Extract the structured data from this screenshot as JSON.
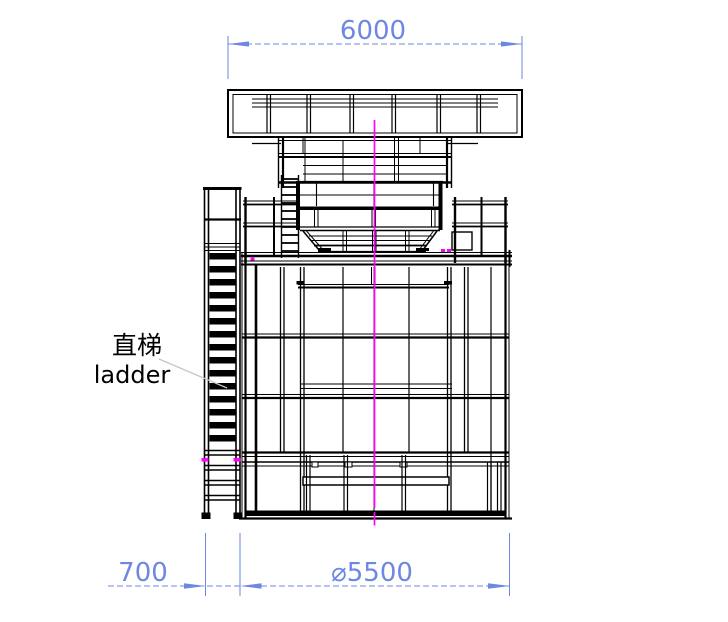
{
  "page": {
    "background": "#ffffff"
  },
  "drawing": {
    "type": "engineering-elevation-drawing",
    "line_color": "#000000",
    "dimension_color": "#6e87e3",
    "centerline_color": "#ff00ff",
    "leader_color": "#c6c6c6",
    "dimensions": {
      "top_width": "6000",
      "ladder_offset": "700",
      "tank_diameter": "⌀5500"
    },
    "labels": {
      "ladder_zh": "直梯",
      "ladder_en": "ladder"
    }
  }
}
